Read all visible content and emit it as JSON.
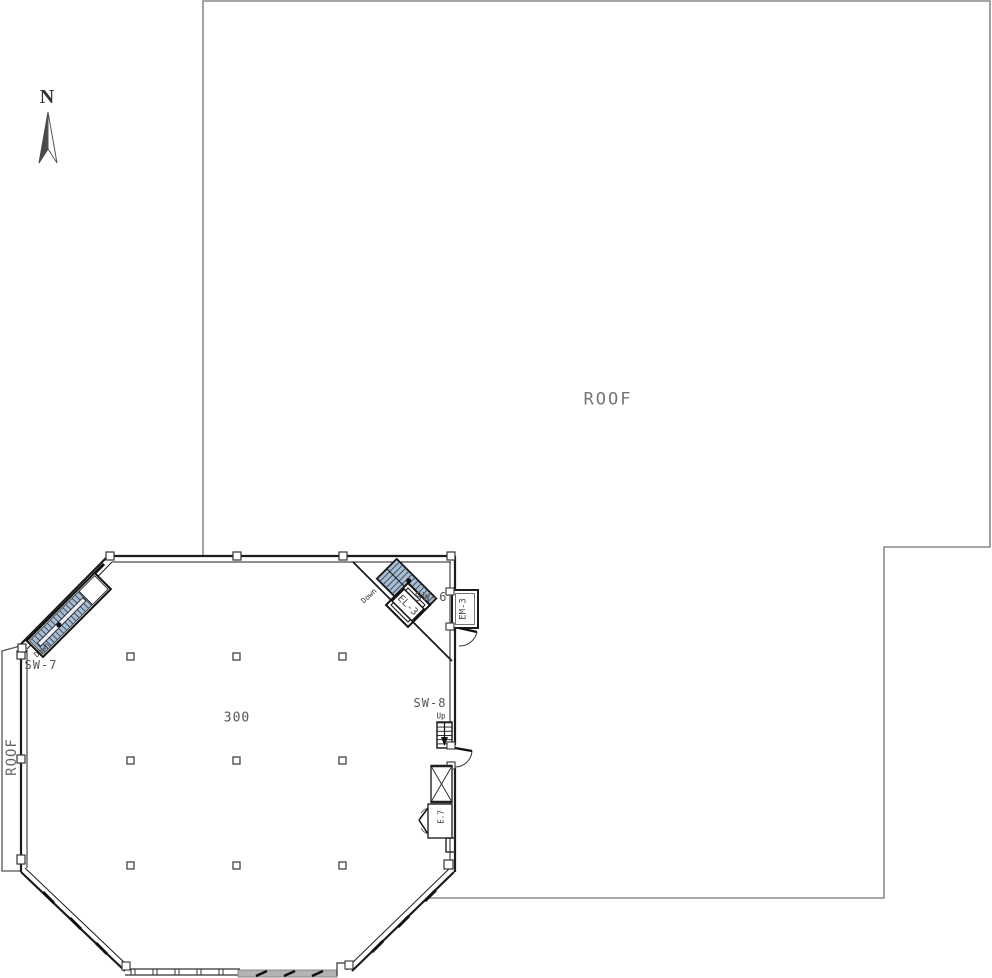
{
  "labels": {
    "north": "N",
    "roof": "ROOF",
    "roof_strip": "ROOF",
    "room": "300",
    "sw6": "SW-6",
    "sw7": "SW-7",
    "sw8": "SW-8",
    "up": "Up",
    "down_sw6": "Down",
    "down_sw7": "Down",
    "el3": "EL-3",
    "em3": "EM-3",
    "e7": "E.7"
  },
  "colors": {
    "wall": "#1c1c1c",
    "roof-line": "#8a8a8a",
    "stair-fill": "#a9bdd1",
    "tread": "#31445a",
    "text": "#5f5f5f"
  }
}
